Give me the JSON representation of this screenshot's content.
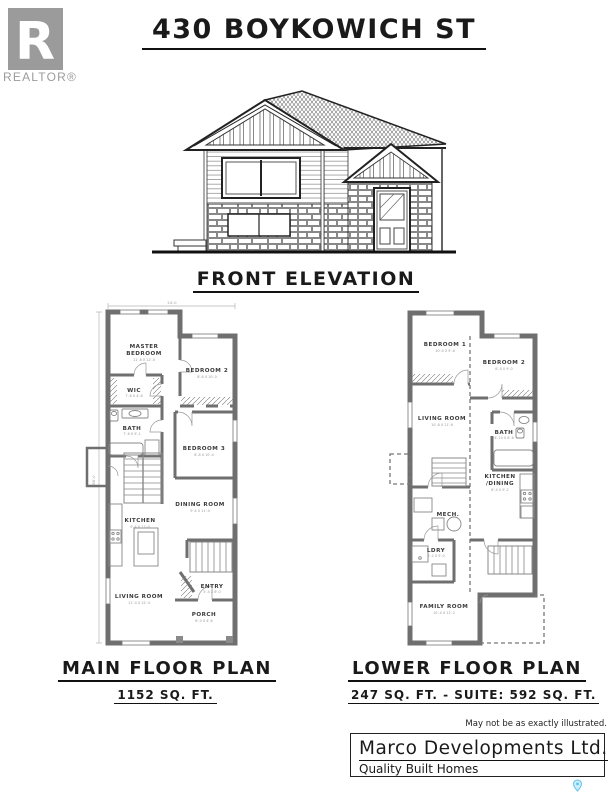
{
  "header": {
    "title": "430 BOYKOWICH ST",
    "realtor_label": "REALTOR®"
  },
  "elevation": {
    "caption": "FRONT ELEVATION"
  },
  "main_plan": {
    "caption": "MAIN FLOOR PLAN",
    "area": "1152 SQ. FT.",
    "overall_width_dim": "24'-0",
    "overall_depth_dim": "56'-0",
    "rooms": {
      "master": {
        "l1": "MASTER",
        "l2": "BEDROOM",
        "dim": "11'-6 X 12'-0"
      },
      "wic": {
        "label": "WIC",
        "dim": "7'-6 X 4'-8"
      },
      "bath": {
        "label": "BATH",
        "dim": "7'-6 X 9'-1"
      },
      "bedroom2": {
        "label": "BEDROOM 2",
        "dim": "8'-8 X 10'-0"
      },
      "bedroom3": {
        "label": "BEDROOM 3",
        "dim": "8'-8 X 10'-4"
      },
      "dining": {
        "label": "DINING ROOM",
        "dim": "9'-4 X 11'-0"
      },
      "kitchen": {
        "label": "KITCHEN",
        "dim": "9'-4 X 11'-0"
      },
      "living": {
        "label": "LIVING ROOM",
        "dim": "11'-4 X 12'-4"
      },
      "entry": {
        "label": "ENTRY",
        "dim": "5'-4 X 6'-0"
      },
      "porch": {
        "label": "PORCH",
        "dim": "6'-0 X 4'-6"
      }
    }
  },
  "lower_plan": {
    "caption": "LOWER FLOOR PLAN",
    "area": "247 SQ. FT. - SUITE: 592 SQ. FT.",
    "rooms": {
      "bedroom1": {
        "label": "BEDROOM 1",
        "dim": "10'-4 X 9'-6"
      },
      "bedroom2": {
        "label": "BEDROOM 2",
        "dim": "8'-4 X 9'-0"
      },
      "living": {
        "label": "LIVING ROOM",
        "dim": "10'-8 X 11'-6"
      },
      "bath": {
        "label": "BATH",
        "dim": "4'-10 X 8'-6"
      },
      "kitchen": {
        "l1": "KITCHEN",
        "l2": "/DINING",
        "dim": "8'-4 X 9'-2"
      },
      "mech": {
        "label": "MECH."
      },
      "ldry": {
        "label": "LDRY",
        "dim": "5'-2 X 5'-0"
      },
      "family": {
        "label": "FAMILY ROOM",
        "dim": "10'-4 X 11'-2"
      }
    }
  },
  "footer": {
    "disclaimer": "May not be as exactly illustrated.",
    "company": "Marco Developments Ltd.",
    "tagline": "Quality Built Homes"
  },
  "colors": {
    "logo_gray": "#9b9b9b",
    "wall_gray": "#6f6f6f",
    "pin_blue": "#5fc3ea"
  }
}
